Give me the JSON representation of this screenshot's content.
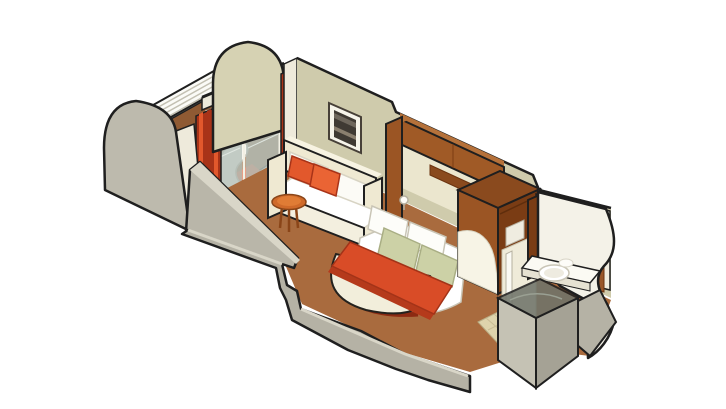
{
  "scene": {
    "type": "isometric-cutaway-illustration",
    "subject": "Cruise ship balcony stateroom floor plan illustration",
    "width": 726,
    "height": 409
  },
  "palette": {
    "background": "#ffffff",
    "outline": "#1f1f1f",
    "wall_khaki": "#cfcbac",
    "wall_khaki_light": "#d6d2b3",
    "wall_cream": "#eeeadb",
    "wall_gray": "#bdbaad",
    "wall_gray_mid": "#b5b2a5",
    "wall_gray_dark": "#a5a295",
    "carpet": "#a96b3e",
    "balcony_floor": "#8f5a33",
    "wood_dark": "#7a3c14",
    "wood": "#9b5524",
    "wood_light": "#b5713a",
    "accent": "#d94c27",
    "accent_dark": "#a83318",
    "accent_bright": "#e2582c",
    "cream": "#efe9d2",
    "white": "#ffffff",
    "pillow_green": "#ccd1a6",
    "glass": "#b7c2bb",
    "shower_glass": "#70746a",
    "tile": "#ded4ac",
    "table_orange": "#cf6a2a",
    "mirror": "#e6dfcc"
  },
  "rooms": {
    "balcony": {
      "id": "balcony",
      "items": [
        "privacy-partition-left",
        "privacy-partition-right",
        "railing",
        "lounge-chair",
        "balcony-table",
        "floor-mat"
      ]
    },
    "living_area": {
      "id": "living-area",
      "items": [
        "sliding-glass-door",
        "curtain-left",
        "curtain-right",
        "sofa",
        "throw-pillows",
        "framed-picture",
        "side-table"
      ]
    },
    "sleeping_area": {
      "id": "sleeping-area",
      "items": [
        "double-bed",
        "white-pillows",
        "green-accent-pillows",
        "bed-runner",
        "foot-bench",
        "headboard-cabinet",
        "reading-lamp",
        "wardrobe"
      ]
    },
    "entry": {
      "id": "entry",
      "items": [
        "doorway",
        "tile-floor"
      ]
    },
    "bathroom": {
      "id": "bathroom",
      "items": [
        "vanity-counter",
        "sink",
        "mirror",
        "shower-stall"
      ]
    }
  }
}
